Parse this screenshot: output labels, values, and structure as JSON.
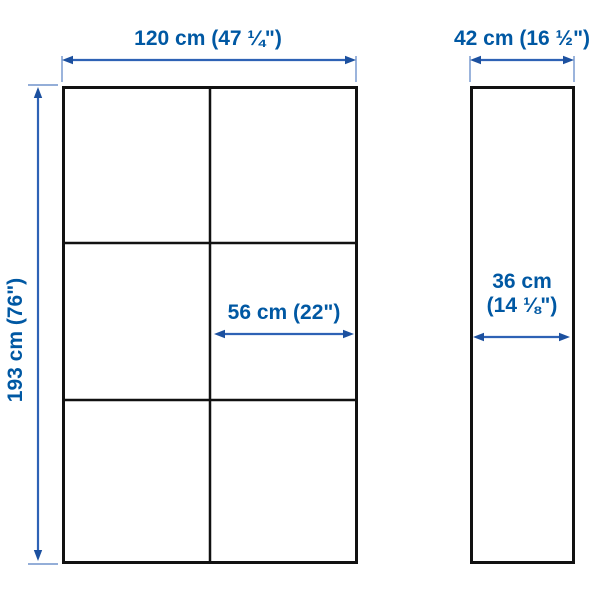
{
  "diagram": {
    "type": "product-dimension-diagram",
    "accent_color": "#0058a3",
    "dimension_line_color": "#2e62b5",
    "outline_color": "#111111",
    "front_view": {
      "columns": 2,
      "rows": 3,
      "width_label": "120 cm (47 ¼\")",
      "height_label": "193 cm (76\")",
      "door_width_label": "56 cm (22\")"
    },
    "side_view": {
      "depth_label": "42 cm (16 ½\")",
      "inner_depth_line1": "36 cm",
      "inner_depth_line2": "(14 ⅛\")"
    }
  }
}
